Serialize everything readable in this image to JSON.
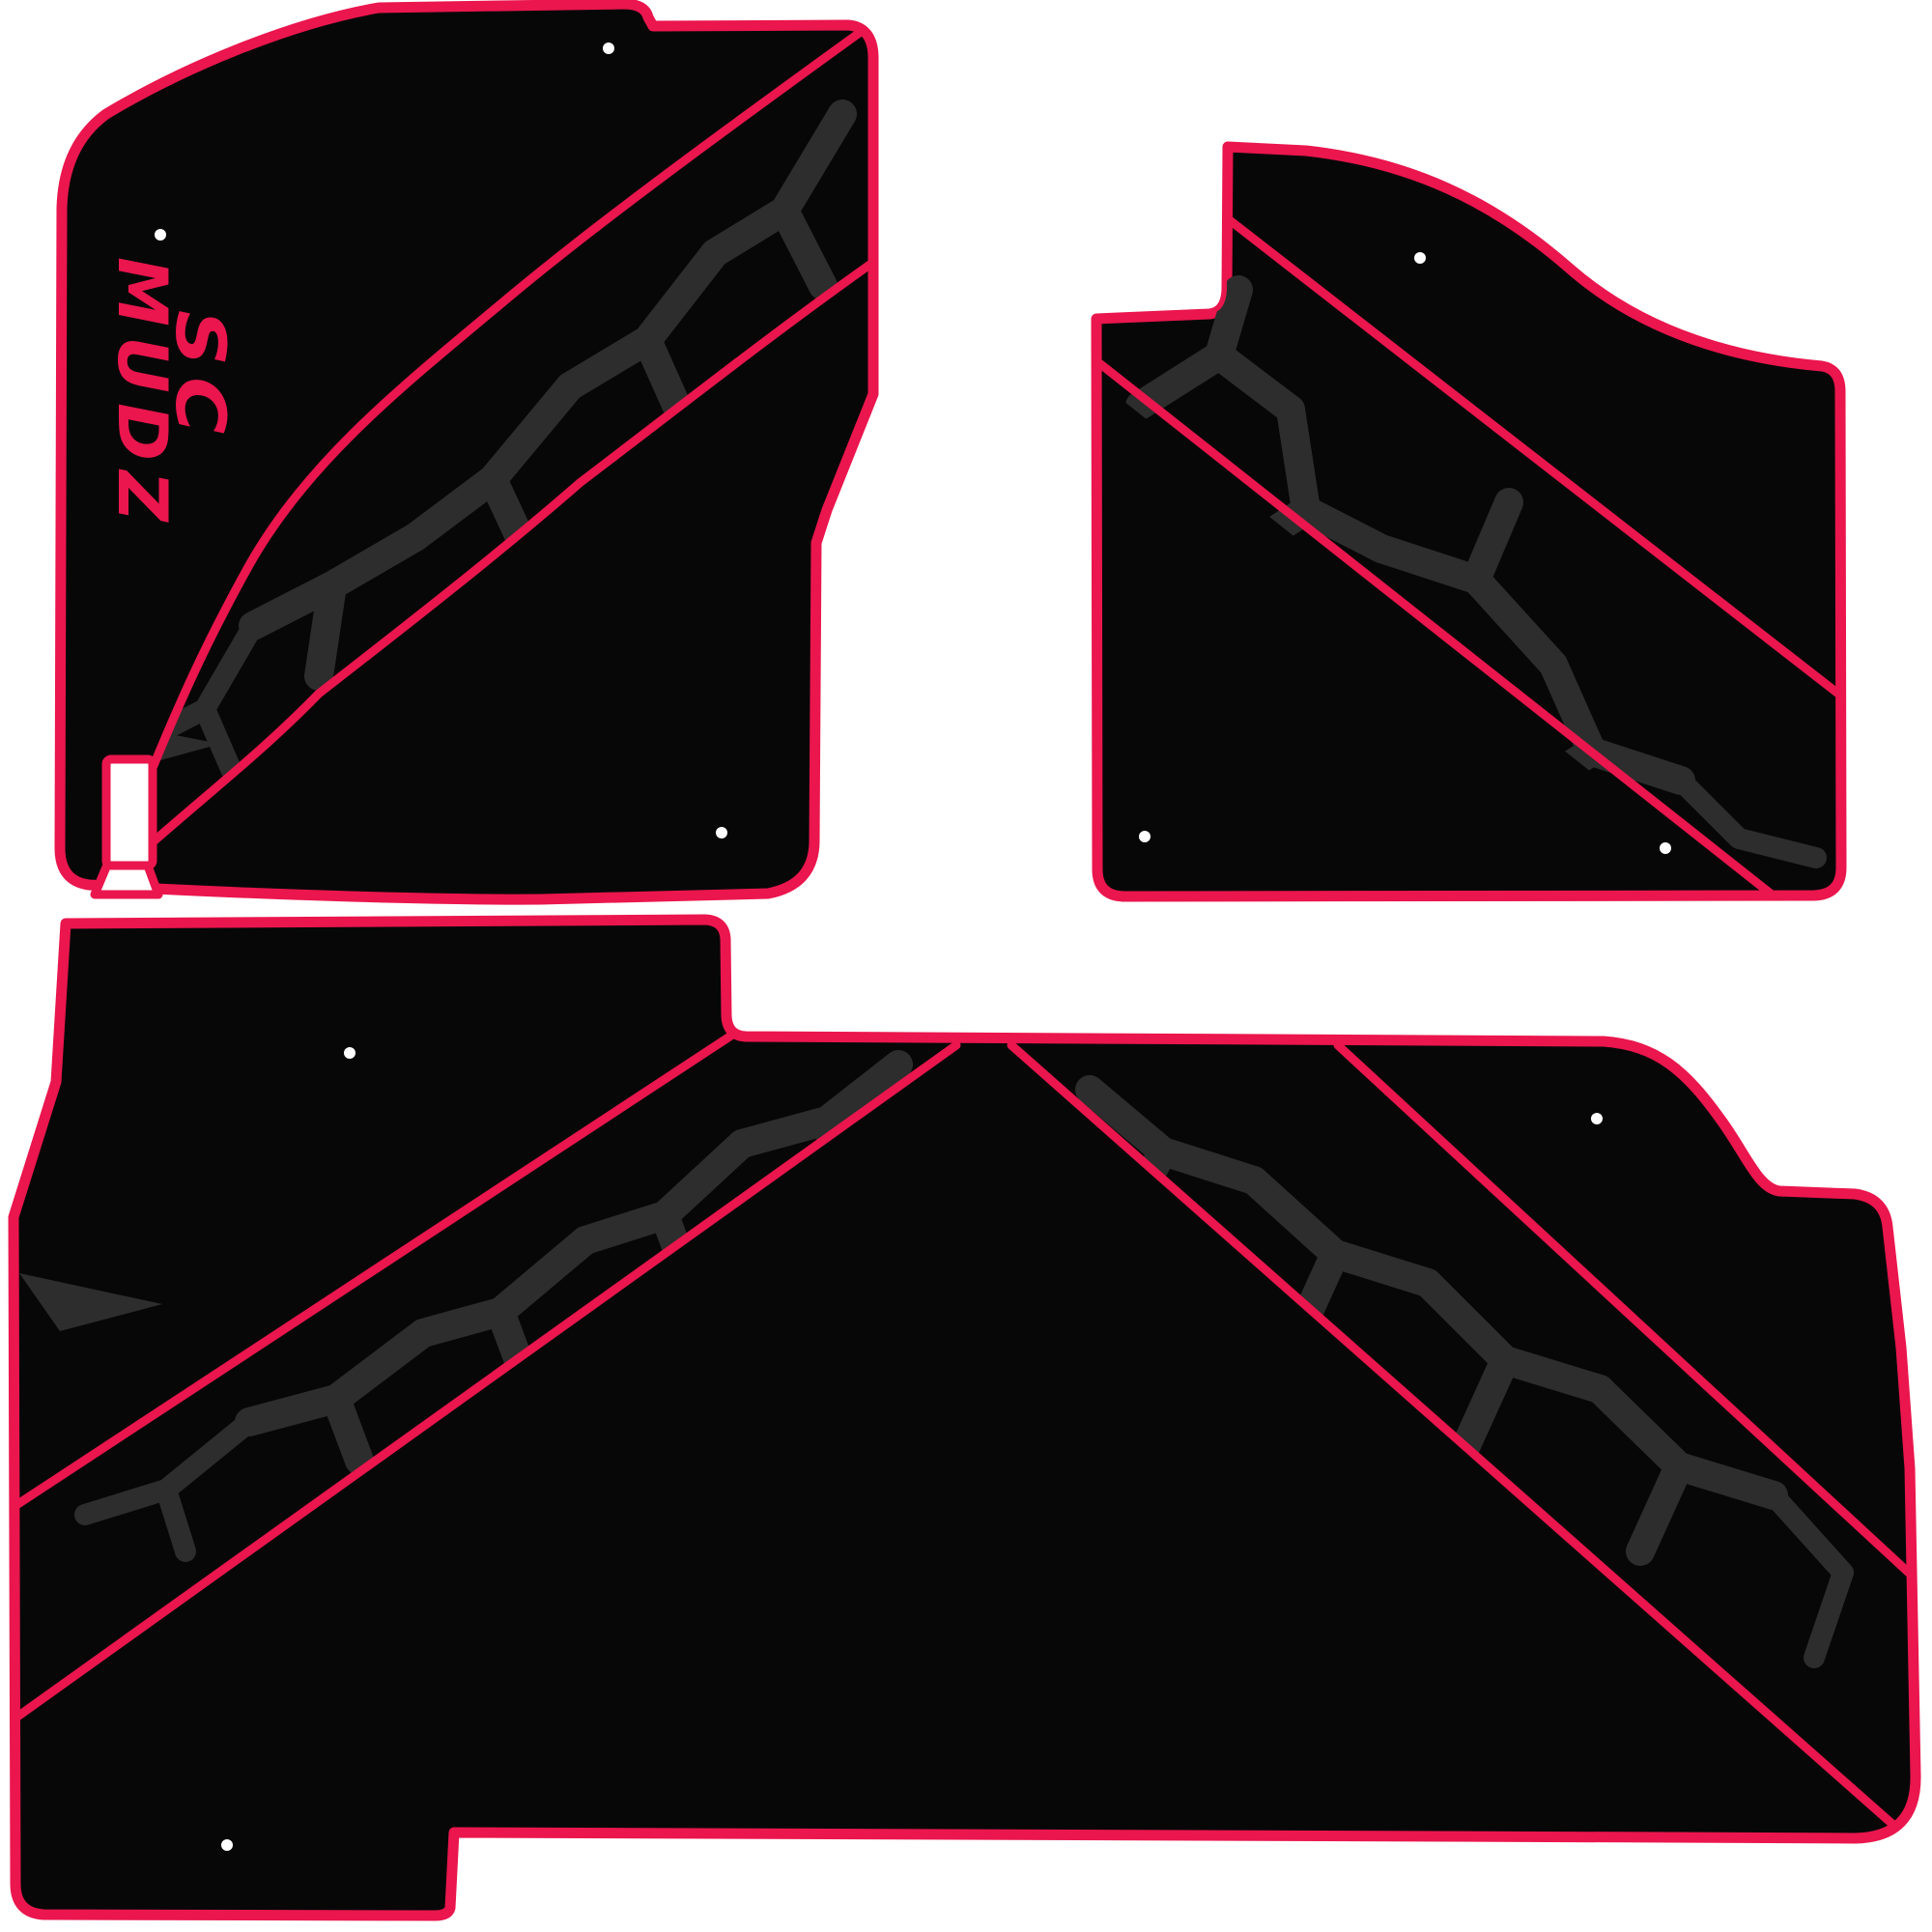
{
  "title": "SC MUDZ three-piece vehicle floor mat set template",
  "background": "#ffffff",
  "colors": {
    "background": "#ffffff",
    "binding": "#ea164d",
    "mat": "#070708",
    "crack": "#2d2d2d",
    "hole": "#ffffff"
  },
  "logo": {
    "line1": "SC",
    "line2": "MUDZ"
  },
  "mats": [
    {
      "id": "front-driver",
      "position": "top-left",
      "holes": 3,
      "has_logo": true,
      "has_heel_cutout": true
    },
    {
      "id": "front-passenger",
      "position": "top-right",
      "holes": 3,
      "has_logo": false,
      "has_heel_cutout": false
    },
    {
      "id": "rear-bench",
      "position": "bottom",
      "holes": 3,
      "has_logo": false,
      "has_heel_cutout": false
    }
  ]
}
